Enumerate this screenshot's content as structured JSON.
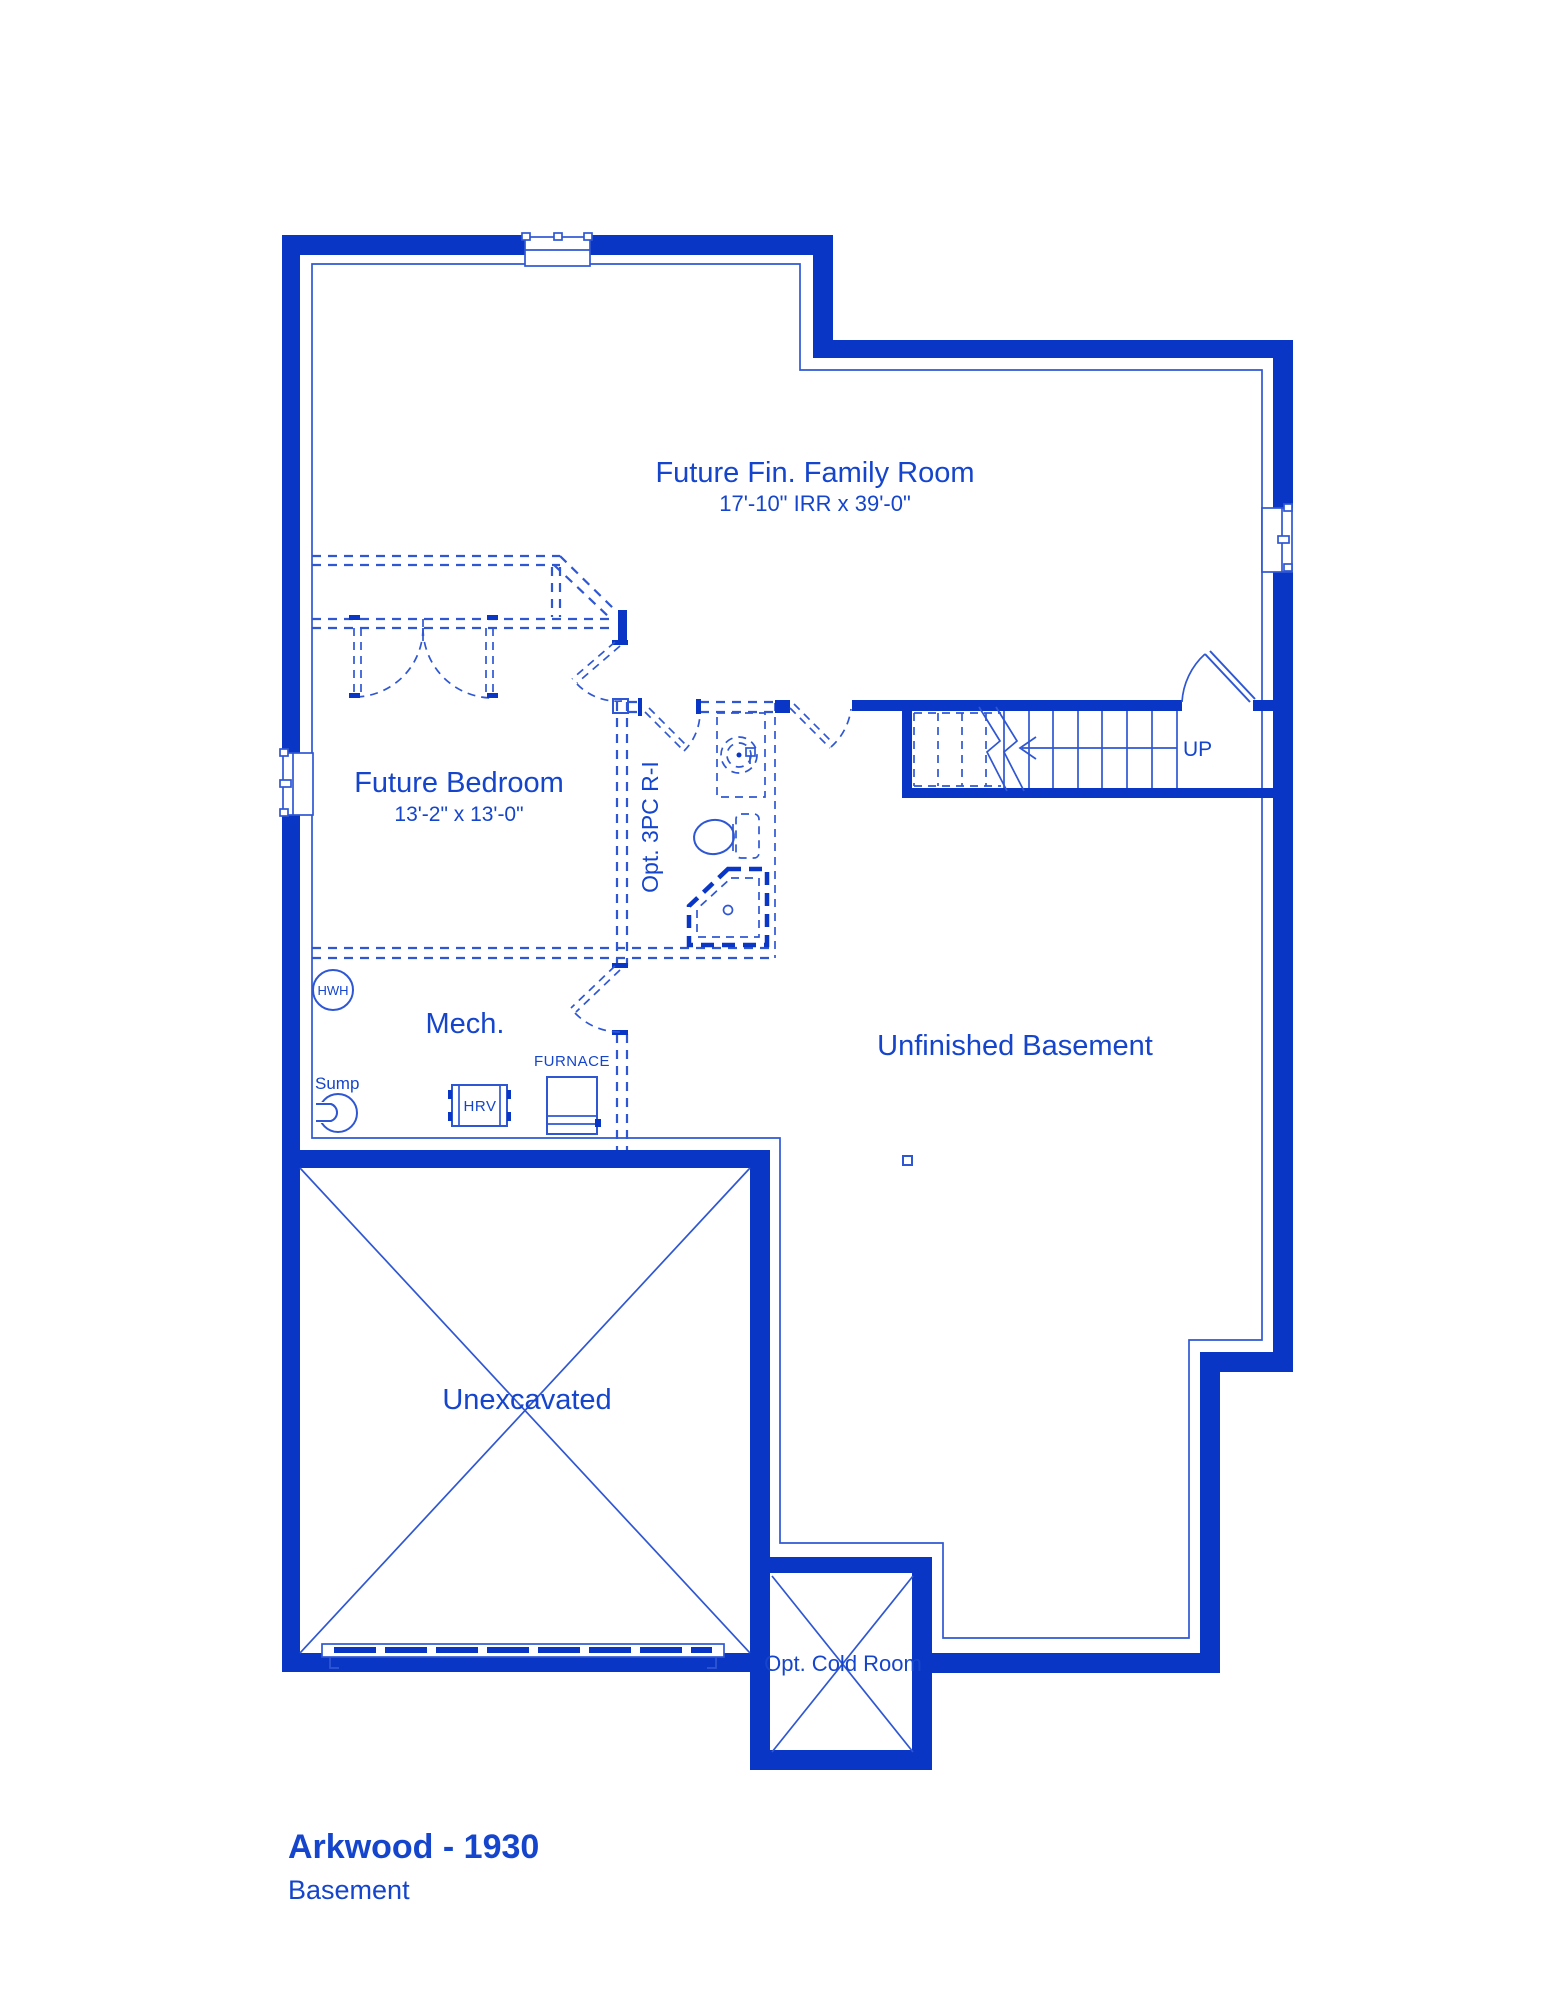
{
  "document": {
    "title": "Arkwood - 1930",
    "subtitle": "Basement"
  },
  "colors": {
    "wall_blue": "#0a36c5",
    "line_blue": "#2f57d3",
    "text_blue": "#1545cc",
    "background": "#ffffff"
  },
  "rooms": {
    "family": {
      "name": "Future Fin. Family Room",
      "dims": "17'-10\" IRR x 39'-0\""
    },
    "bedroom": {
      "name": "Future Bedroom",
      "dims": "13'-2\" x 13'-0\""
    },
    "bath": {
      "name": "Opt. 3PC R-I"
    },
    "basement": {
      "name": "Unfinished Basement"
    },
    "mech": {
      "name": "Mech."
    },
    "unexcavated": {
      "name": "Unexcavated"
    },
    "cold_room": {
      "name": "Opt. Cold Room"
    }
  },
  "labels": {
    "stairs_direction": "UP",
    "water_heater": "HWH",
    "sump": "Sump",
    "hrv": "HRV",
    "furnace": "FURNACE"
  }
}
